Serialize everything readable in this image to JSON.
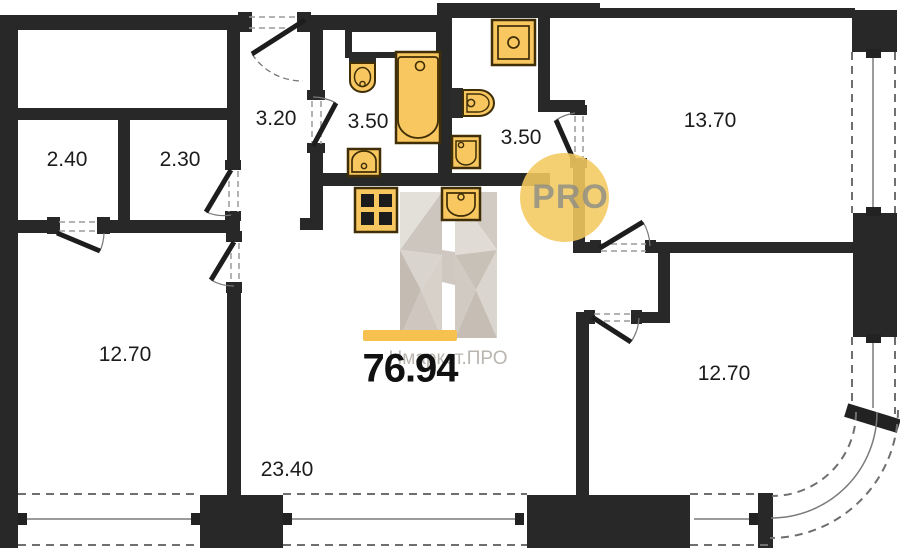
{
  "floorplan": {
    "total_area": "76.94",
    "watermark": {
      "pro": "PRO",
      "brand": "Нмаркет.ПРО"
    },
    "rooms": [
      {
        "name": "storage-left",
        "area": "2.40"
      },
      {
        "name": "storage-right",
        "area": "2.30"
      },
      {
        "name": "hallway",
        "area": "3.20"
      },
      {
        "name": "bathroom-left",
        "area": "3.50"
      },
      {
        "name": "bathroom-right",
        "area": "3.50"
      },
      {
        "name": "bedroom-top-right",
        "area": "13.70"
      },
      {
        "name": "bedroom-left",
        "area": "12.70"
      },
      {
        "name": "bedroom-bottom-right",
        "area": "12.70"
      },
      {
        "name": "kitchen-living",
        "area": "23.40"
      }
    ],
    "fixtures": [
      "toilet-icon",
      "bathtub-icon",
      "sink-icon",
      "washing-machine-icon",
      "wall-toilet-icon",
      "stove-icon",
      "kitchen-sink-icon"
    ],
    "colors": {
      "wall": "#282828",
      "fixture_fill": "#F8C75F",
      "fixture_stroke": "#3f2e06",
      "accent_bar": "#F6C14E",
      "pro_circle": "#F3C95E",
      "watermark_gray": "#b3aea7"
    }
  }
}
